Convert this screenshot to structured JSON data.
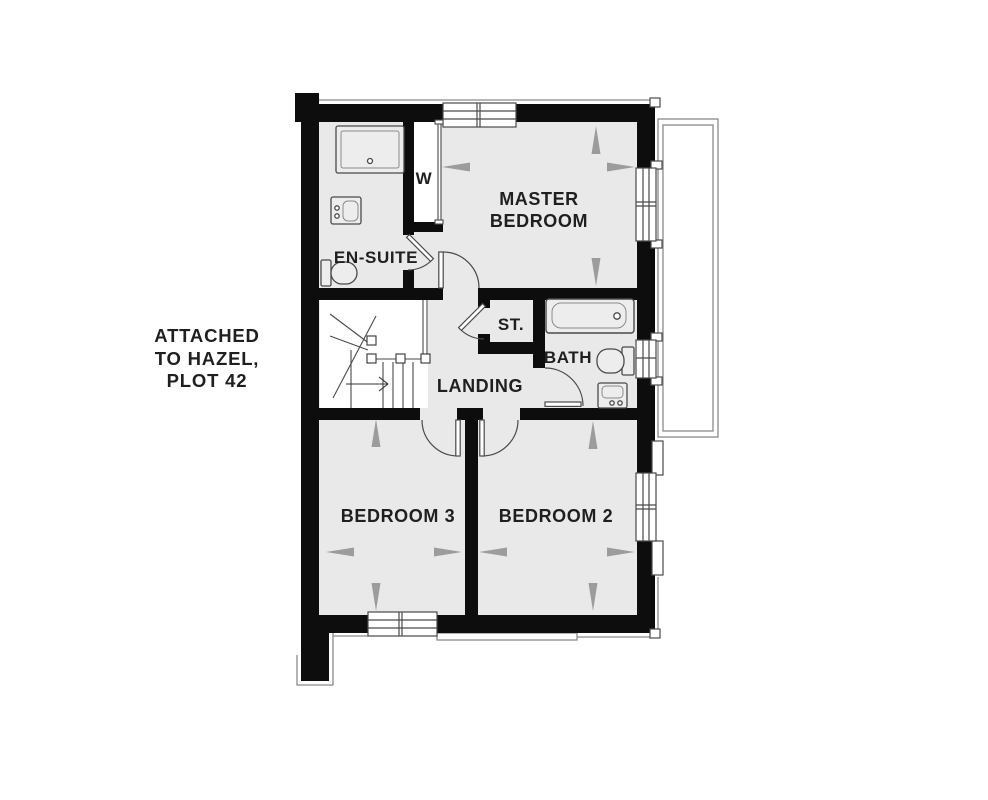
{
  "annotation": {
    "lines": [
      "ATTACHED",
      "TO HAZEL,",
      "PLOT 42"
    ]
  },
  "rooms": {
    "master_bedroom": {
      "label_lines": [
        "MASTER",
        "BEDROOM"
      ]
    },
    "en_suite": {
      "label": "EN-SUITE"
    },
    "wardrobe": {
      "label": "W"
    },
    "store": {
      "label": "ST."
    },
    "bath": {
      "label": "BATH"
    },
    "landing": {
      "label": "LANDING"
    },
    "bedroom_3": {
      "label": "BEDROOM 3"
    },
    "bedroom_2": {
      "label": "BEDROOM 2"
    }
  },
  "fixtures": [
    "shower-tray",
    "en-suite-sink",
    "en-suite-toilet",
    "bath-tub",
    "bath-toilet",
    "bath-sink",
    "staircase",
    "stairs-up-arrow"
  ],
  "colors": {
    "bg": "#ffffff",
    "wall": "#0d0d0d",
    "room_fill": "#e9e9e9",
    "closet_fill": "#ffffff",
    "fixture_fill": "#ededed",
    "line": "#4a4a4a",
    "line_light": "#8a8a8a",
    "roofline": "#8a8a8a",
    "arrow": "#9c9c9c",
    "text": "#1f1f1f"
  }
}
